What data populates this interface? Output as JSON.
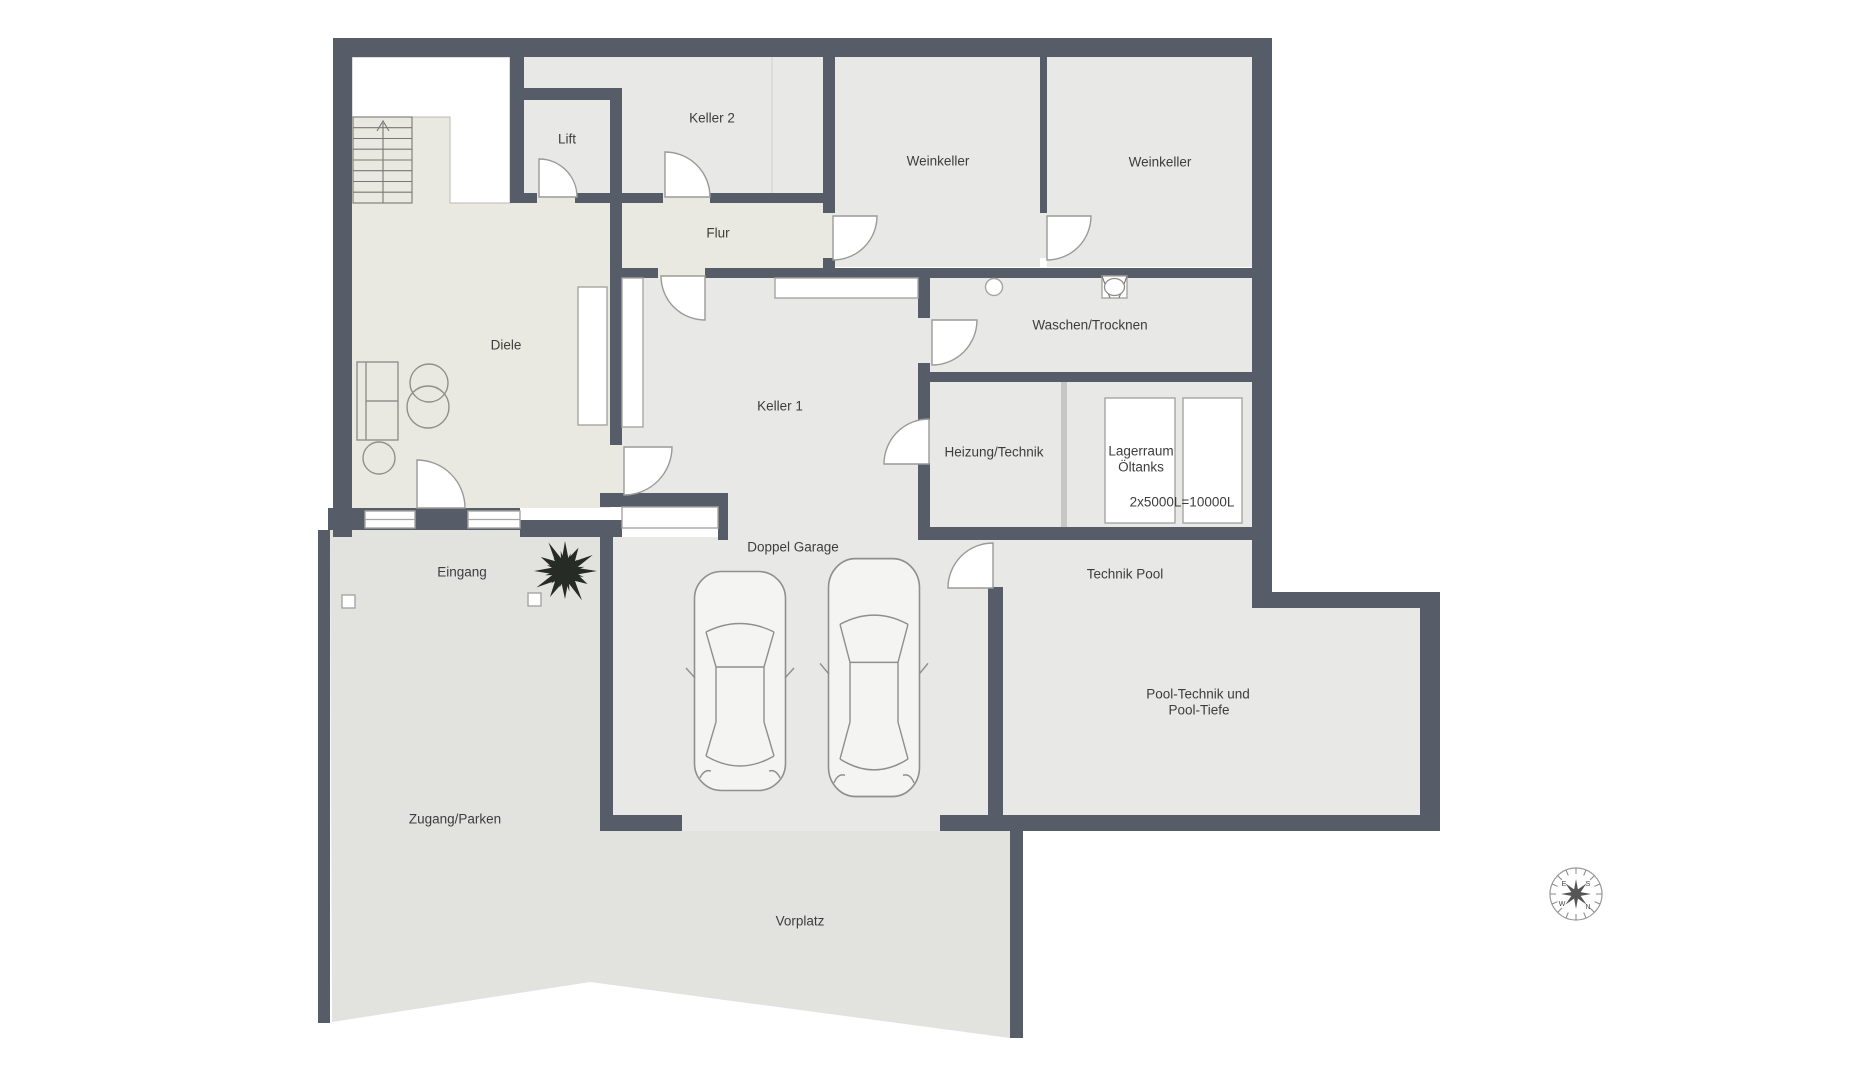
{
  "rooms": {
    "lift": "Lift",
    "keller2": "Keller 2",
    "weinkeller_left": "Weinkeller",
    "weinkeller_right": "Weinkeller",
    "flur": "Flur",
    "diele": "Diele",
    "keller1": "Keller 1",
    "waschen_trocknen": "Waschen/Trocknen",
    "heizung_technik": "Heizung/Technik",
    "lagerraum_line1": "Lagerraum",
    "lagerraum_line2": "Öltanks",
    "tank_capacity": "2x5000L=10000L",
    "doppel_garage": "Doppel Garage",
    "technik_pool": "Technik Pool",
    "pool_line1": "Pool-Technik und",
    "pool_line2": "Pool-Tiefe",
    "eingang": "Eingang",
    "zugang_parken": "Zugang/Parken",
    "vorplatz": "Vorplatz"
  },
  "compass": {
    "n": "N",
    "e": "E",
    "s": "S",
    "w": "W"
  },
  "colors": {
    "wall": "#575d68",
    "room_floor": "#e8e8e6",
    "hall_floor": "#eae9e1",
    "outdoor_floor": "#e2e2df",
    "door_fill": "#ffffff",
    "drawing_line": "#9a9a98",
    "label_text": "#3d3d3d"
  }
}
